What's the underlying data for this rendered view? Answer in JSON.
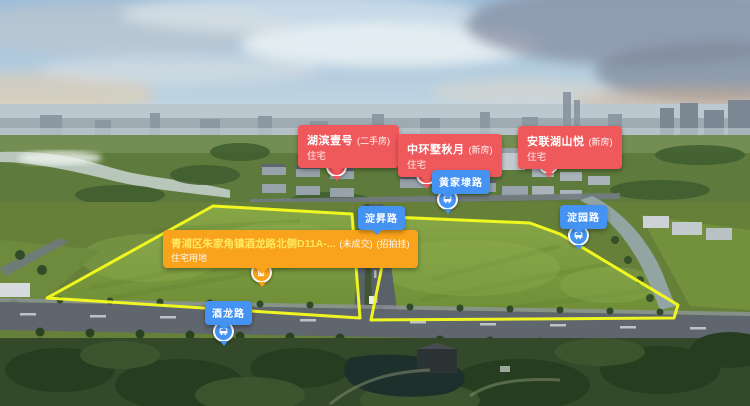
{
  "colors": {
    "property_label": "#f0595b",
    "land_label": "#f9a21b",
    "road_label": "#4493f2",
    "parcel_outline": "#f7fd1e",
    "land_title_text": "#ffe95e"
  },
  "property_labels": [
    {
      "name": "湖滨壹号",
      "tag": "(二手房)",
      "category": "住宅"
    },
    {
      "name": "中环墅秋月",
      "tag": "(新房)",
      "category": "住宅"
    },
    {
      "name": "安联湖山悦",
      "tag": "(新房)",
      "category": "住宅"
    }
  ],
  "land_parcel_label": {
    "title": "青浦区朱家角镇酒龙路北侧D11A-...",
    "status": "(未成交)",
    "sale_method": "(招拍挂)",
    "category": "住宅用地"
  },
  "road_labels": [
    {
      "name": "黄家埭路"
    },
    {
      "name": "淀昇路"
    },
    {
      "name": "淀园路"
    },
    {
      "name": "酒龙路"
    }
  ],
  "icons": {
    "property_marker": "building-icon",
    "road_marker": "bus-icon",
    "land_parcel_marker": "building-icon"
  }
}
